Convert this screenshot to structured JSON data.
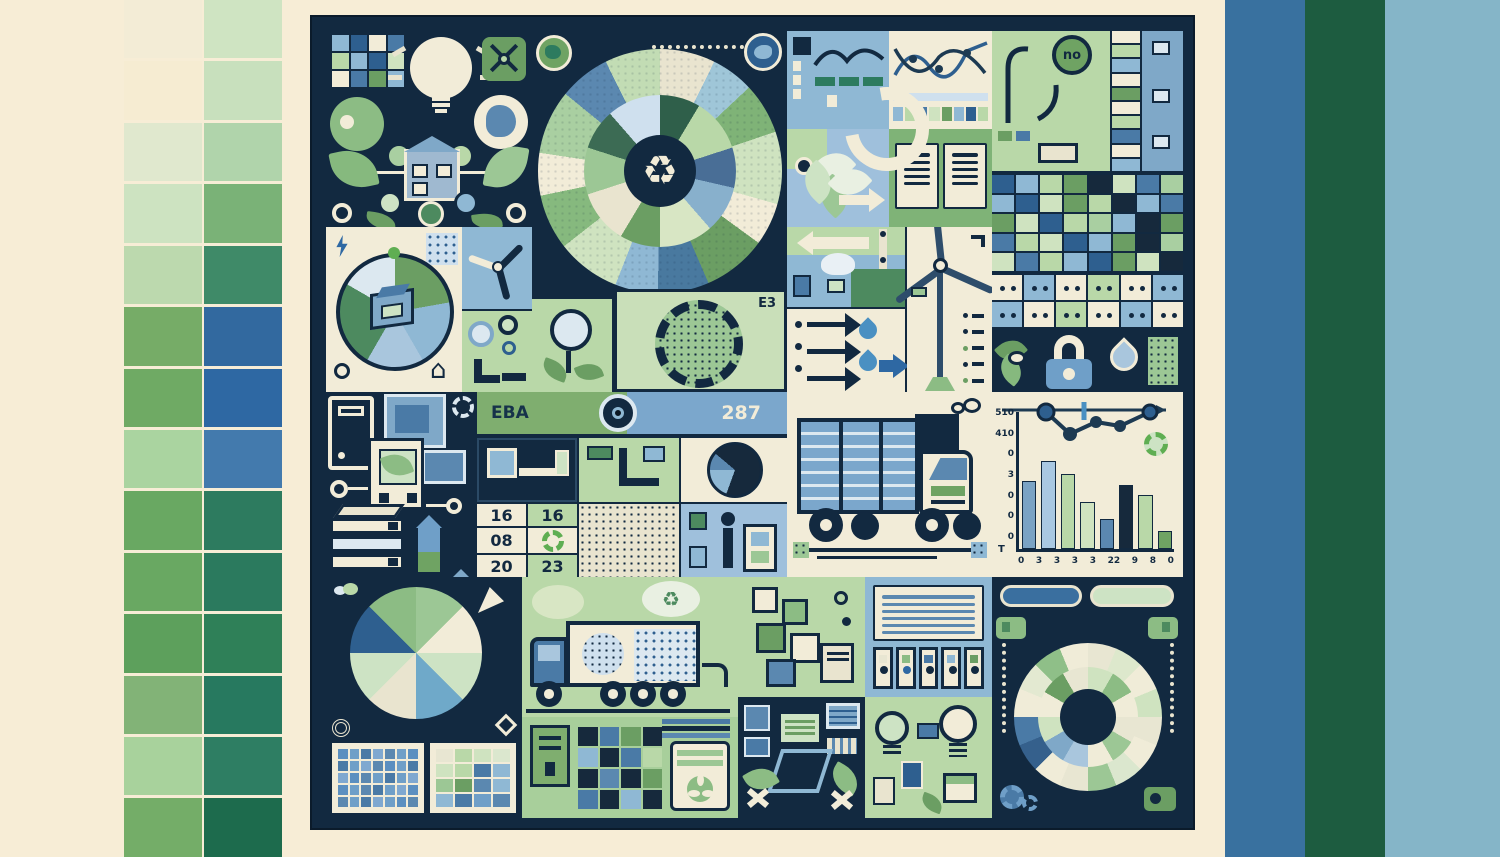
{
  "meta": {
    "description": "Green and blue sustainability infographic collage poster"
  },
  "colors": {
    "page_bg": "#f7edd6",
    "panel_bg": "#122940",
    "cream": "#f2ecd8",
    "green_tile": "#b9d8a8",
    "green_mid": "#7fb377",
    "blue_tile": "#8fb8d4",
    "steel_blue": "#3a6f9f",
    "dark_green_band": "#1d5c40",
    "light_blue_band": "#85b5c8"
  },
  "palette_left": [
    [
      "#f3ecd6",
      "#cfe4c2"
    ],
    [
      "#f6ecd2",
      "#c8e0bd"
    ],
    [
      "#e0e8ce",
      "#b0d4ab"
    ],
    [
      "#cde3c1",
      "#7ab277"
    ],
    [
      "#bcd9ae",
      "#3f8a68"
    ],
    [
      "#76ac67",
      "#32699f"
    ],
    [
      "#6faa64",
      "#2e68a3"
    ],
    [
      "#aad4a0",
      "#437aad"
    ],
    [
      "#69a862",
      "#2d7b5f"
    ],
    [
      "#69a862",
      "#2b7a5e"
    ],
    [
      "#5da05c",
      "#2f8058"
    ],
    [
      "#82b377",
      "#27795f"
    ],
    [
      "#a8d29c",
      "#2e7e63"
    ],
    [
      "#74ad68",
      "#1d6b4d"
    ]
  ],
  "bands_right": [
    "#39719f",
    "#1d5c40",
    "#85b5c8"
  ],
  "icons": {
    "recycle": "♻",
    "house": "⌂",
    "caret": "▾"
  },
  "labels": {
    "eba": "EBA",
    "code": "287",
    "gear_tag": "E3",
    "no_bubble": "no"
  },
  "cal": {
    "a": "16",
    "b": "16",
    "c": "08",
    "d": "20",
    "e": "23"
  },
  "bar_chart": {
    "yticks": [
      "510",
      "410",
      "0",
      "3",
      "0",
      "0",
      "0"
    ],
    "origin": "T",
    "xticks": [
      "0",
      "3",
      "3",
      "3",
      "3",
      "22",
      "9",
      "8",
      "0"
    ],
    "values": [
      60,
      78,
      66,
      42,
      27,
      57,
      48,
      16
    ],
    "colors": [
      "#7ba3c4",
      "#a9c8e2",
      "#b9d8a8",
      "#cfe3c0",
      "#5b88b0",
      "#16293c",
      "#b9d8a8",
      "#6fa363"
    ],
    "max": 100
  },
  "sunburst_outer": {
    "colors": [
      "#e9e4cf",
      "#9fc6d8",
      "#7fb377",
      "#cfe3c0",
      "#f2ecd8",
      "#6b9e63",
      "#49799f",
      "#8fb8d4",
      "#cfe3c0",
      "#86b97e",
      "#f2ecd8",
      "#a9cfa1",
      "#5b88b0",
      "#c2dcb4"
    ],
    "values": [
      26,
      20,
      24,
      34,
      20,
      30,
      24,
      20,
      30,
      26,
      20,
      30,
      24,
      26
    ]
  },
  "sunburst_inner": {
    "colors": [
      "#2f5f4a",
      "#b9d8a8",
      "#496e96",
      "#88b0cc",
      "#d8e6c4",
      "#6b9e63",
      "#e9e4cf",
      "#9cc795",
      "#3c6b54",
      "#cfe0ee"
    ],
    "values": [
      30,
      40,
      30,
      35,
      40,
      30,
      40,
      35,
      30,
      40
    ]
  },
  "ballot_pie": {
    "colors": [
      "#6b9e63",
      "#8fb8d4",
      "#a9c6dd",
      "#4d8a5f",
      "#dce8f0"
    ],
    "values": [
      80,
      70,
      60,
      90,
      60
    ]
  },
  "mini_pie": {
    "colors": [
      "#16293c",
      "#8fb8d4",
      "#5b88b0",
      "#16293c"
    ],
    "values": [
      200,
      70,
      40,
      50
    ]
  },
  "pie8": {
    "colors": [
      "#9cc795",
      "#f2ecd8",
      "#cde3c4",
      "#6fa9c9",
      "#e9e4cf",
      "#cde3c4",
      "#2e5f8f",
      "#8cbc84"
    ],
    "values": [
      45,
      45,
      45,
      45,
      45,
      45,
      45,
      45
    ]
  },
  "donut_outer": {
    "colors": [
      "#e8e6d2",
      "#dde8cc",
      "#f0ecd8",
      "#cfe3c0",
      "#e8e6d2",
      "#f0ecd8",
      "#dbe7ce",
      "#9cc795",
      "#e8e6d2",
      "#f0ecd8",
      "#35608c",
      "#4a7aa6",
      "#f0ecd8",
      "#e3e9d1",
      "#8fbf88",
      "#f0ecd8"
    ],
    "values": [
      22,
      22,
      22,
      22,
      22,
      22,
      22,
      22,
      22,
      22,
      22,
      22,
      22,
      22,
      22,
      22
    ]
  },
  "donut_inner": {
    "colors": [
      "#cfe3c0",
      "#8cbc84",
      "#f0ecd8",
      "#e8e6d2",
      "#9cc795",
      "#f0ecd8",
      "#a9c6dd",
      "#7fa8c8",
      "#cfe3c0",
      "#f0ecd8",
      "#6b9e63",
      "#e8e6d2"
    ],
    "values": [
      30,
      30,
      30,
      30,
      30,
      30,
      30,
      30,
      30,
      30,
      30,
      30
    ]
  },
  "idea_grid": [
    "#8fb8d4",
    "#2e5f8f",
    "#f2ecd8",
    "#4a7aa6",
    "#b9d8a8",
    "#8fb8d4",
    "#2e5f8f",
    "#cfe3c0",
    "#f2ecd8",
    "#4a7aa6",
    "#6b9e63",
    "#8fb8d4"
  ],
  "strip_c2": [
    "#8fb8d4",
    "#b9d8a8",
    "#4a7aa6",
    "#cfe3c0",
    "#6b9e63",
    "#8fb8d4",
    "#2e5f8f",
    "#b9d8a8"
  ],
  "stack_d": [
    "#f2ecd8",
    "#b9d8a8",
    "#8fb8d4",
    "#f2ecd8",
    "#6b9e63",
    "#f2ecd8",
    "#b9d8a8",
    "#4a7aa6",
    "#f2ecd8",
    "#8fb8d4"
  ],
  "waffle_tr": [
    "#2e5f8f",
    "#8fb8d4",
    "#b9d8a8",
    "#6b9e63",
    "#16293c",
    "#cfe3c0",
    "#4a7aa6",
    "#a9cfa1",
    "#8fb8d4",
    "#2e5f8f",
    "#cfe3c0",
    "#6b9e63",
    "#b9d8a8",
    "#16293c",
    "#8fb8d4",
    "#4a7aa6",
    "#6b9e63",
    "#cfe3c0",
    "#2e5f8f",
    "#b9d8a8",
    "#a9cfa1",
    "#8fb8d4",
    "#16293c",
    "#6b9e63",
    "#4a7aa6",
    "#b9d8a8",
    "#cfe3c0",
    "#2e5f8f",
    "#8fb8d4",
    "#6b9e63",
    "#16293c",
    "#a9cfa1",
    "#cfe3c0",
    "#4a7aa6",
    "#b9d8a8",
    "#8fb8d4",
    "#2e5f8f",
    "#6b9e63",
    "#cfe3c0",
    "#16293c"
  ],
  "dominoes": [
    "#f2ecd8",
    "#8fb8d4",
    "#f2ecd8",
    "#b9d8a8",
    "#f2ecd8",
    "#8fb8d4",
    "#8fb8d4",
    "#f2ecd8",
    "#b9d8a8",
    "#f2ecd8",
    "#8fb8d4",
    "#f2ecd8"
  ],
  "grid_solar": [
    "#5b8fc0",
    "#6f9fc8",
    "#4a7aa6",
    "#7fa8d0",
    "#5b88b0",
    "#6f9fc8",
    "#5b8fc0",
    "#4a7aa6",
    "#6f9fc8",
    "#7fa8d0",
    "#5b88b0",
    "#5b8fc0",
    "#6f9fc8",
    "#4a7aa6",
    "#7fa8d0",
    "#5b8fc0",
    "#5b88b0",
    "#6f9fc8",
    "#4a7aa6",
    "#6f9fc8",
    "#7fa8d0",
    "#5b8fc0",
    "#6f9fc8",
    "#5b88b0",
    "#4a7aa6",
    "#6f9fc8",
    "#7fa8d0",
    "#5b8fc0",
    "#5b88b0",
    "#6f9fc8",
    "#4a7aa6",
    "#7fa8d0",
    "#6f9fc8",
    "#5b8fc0",
    "#5b88b0"
  ],
  "grid_mixed": [
    "#e8e6d2",
    "#b9d8a8",
    "#cfe3c0",
    "#dbe7ce",
    "#cfe3c0",
    "#b9d8a8",
    "#4a7aa6",
    "#8fb8d4",
    "#9cc795",
    "#6b9e63",
    "#5b88b0",
    "#8fb8d4",
    "#8fb8d4",
    "#4a7aa6",
    "#6f9fc8",
    "#5b88b0"
  ],
  "waffle_m": [
    "#16293c",
    "#4a7aa6",
    "#6b9e63",
    "#16293c",
    "#8fb8d4",
    "#16293c",
    "#4a7aa6",
    "#b9d8a8",
    "#16293c",
    "#5b88b0",
    "#16293c",
    "#6b9e63",
    "#4a7aa6",
    "#16293c",
    "#8fb8d4",
    "#16293c"
  ],
  "bins": [
    "#e8e6d2",
    "#8cbc84",
    "#4a7aa6",
    "#8fb8d4",
    "#6b9e63"
  ],
  "chart_data": [
    {
      "type": "bar",
      "categories": [
        "0",
        "3",
        "3",
        "3",
        "3",
        "22",
        "9",
        "8",
        "0"
      ],
      "values": [
        60,
        78,
        66,
        42,
        27,
        57,
        48,
        16
      ],
      "title": "",
      "xlabel": "",
      "ylabel": "",
      "yticks": [
        "510",
        "410"
      ],
      "note": "decorative bar chart with overlay line"
    },
    {
      "type": "pie",
      "categories": [
        "s1",
        "s2",
        "s3",
        "s4",
        "s5",
        "s6",
        "s7",
        "s8"
      ],
      "values": [
        45,
        45,
        45,
        45,
        45,
        45,
        45,
        45
      ],
      "title": "eight-slice pie"
    },
    {
      "type": "pie",
      "categories": [
        "ring of 16 equal segments"
      ],
      "values": [
        22
      ],
      "title": "double ring donut"
    }
  ]
}
